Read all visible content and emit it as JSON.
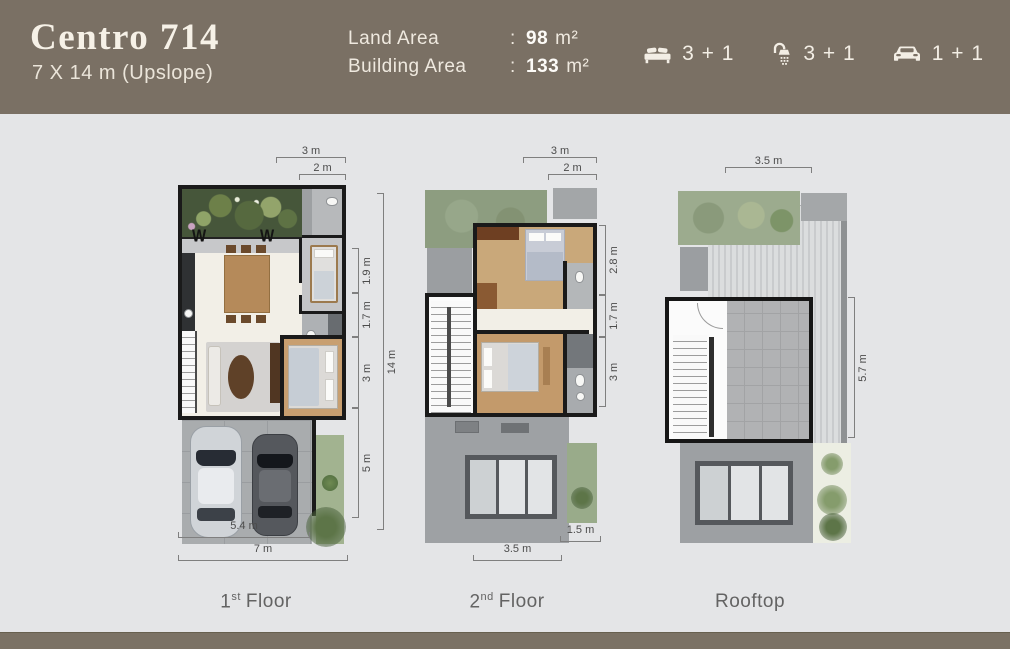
{
  "header": {
    "title": "Centro 714",
    "subtitle": "7 X 14 m (Upslope)",
    "areas": {
      "rows": [
        {
          "label": "Land Area",
          "separator": ":",
          "value": "98",
          "unit": "m²"
        },
        {
          "label": "Building Area",
          "separator": ":",
          "value": "133",
          "unit": "m²"
        }
      ]
    },
    "stats": [
      {
        "icon": "bed-icon",
        "value": "3 + 1"
      },
      {
        "icon": "shower-icon",
        "value": "3 + 1"
      },
      {
        "icon": "car-icon",
        "value": "1 + 1"
      }
    ]
  },
  "floors": [
    {
      "label": {
        "num": "1",
        "sup": "st",
        "word": "Floor"
      },
      "window_symbol": "W",
      "dims": {
        "top": [
          "3 m",
          "2 m"
        ],
        "right": [
          "1.9 m",
          "1.7 m",
          "3 m",
          "5 m"
        ],
        "right_total": "14 m",
        "bottom": [
          "5.4 m",
          "7 m"
        ]
      }
    },
    {
      "label": {
        "num": "2",
        "sup": "nd",
        "word": "Floor"
      },
      "dims": {
        "top": [
          "3 m",
          "2 m"
        ],
        "right": [
          "2.8 m",
          "1.7 m",
          "3 m"
        ],
        "bottom": [
          "3.5 m",
          "1.5 m"
        ]
      }
    },
    {
      "label": {
        "num": "",
        "sup": "",
        "word": "Rooftop"
      },
      "dims": {
        "top": [
          "3.5 m"
        ],
        "right": [
          "5.7 m"
        ]
      }
    }
  ],
  "colors": {
    "header_bg": "#7a7064",
    "footer_bg": "#7b7265",
    "body_bg": "#e4e5e7",
    "header_text": "#f3eee5",
    "dim_text": "#4c4c4c",
    "wall": "#1a1a1a"
  }
}
